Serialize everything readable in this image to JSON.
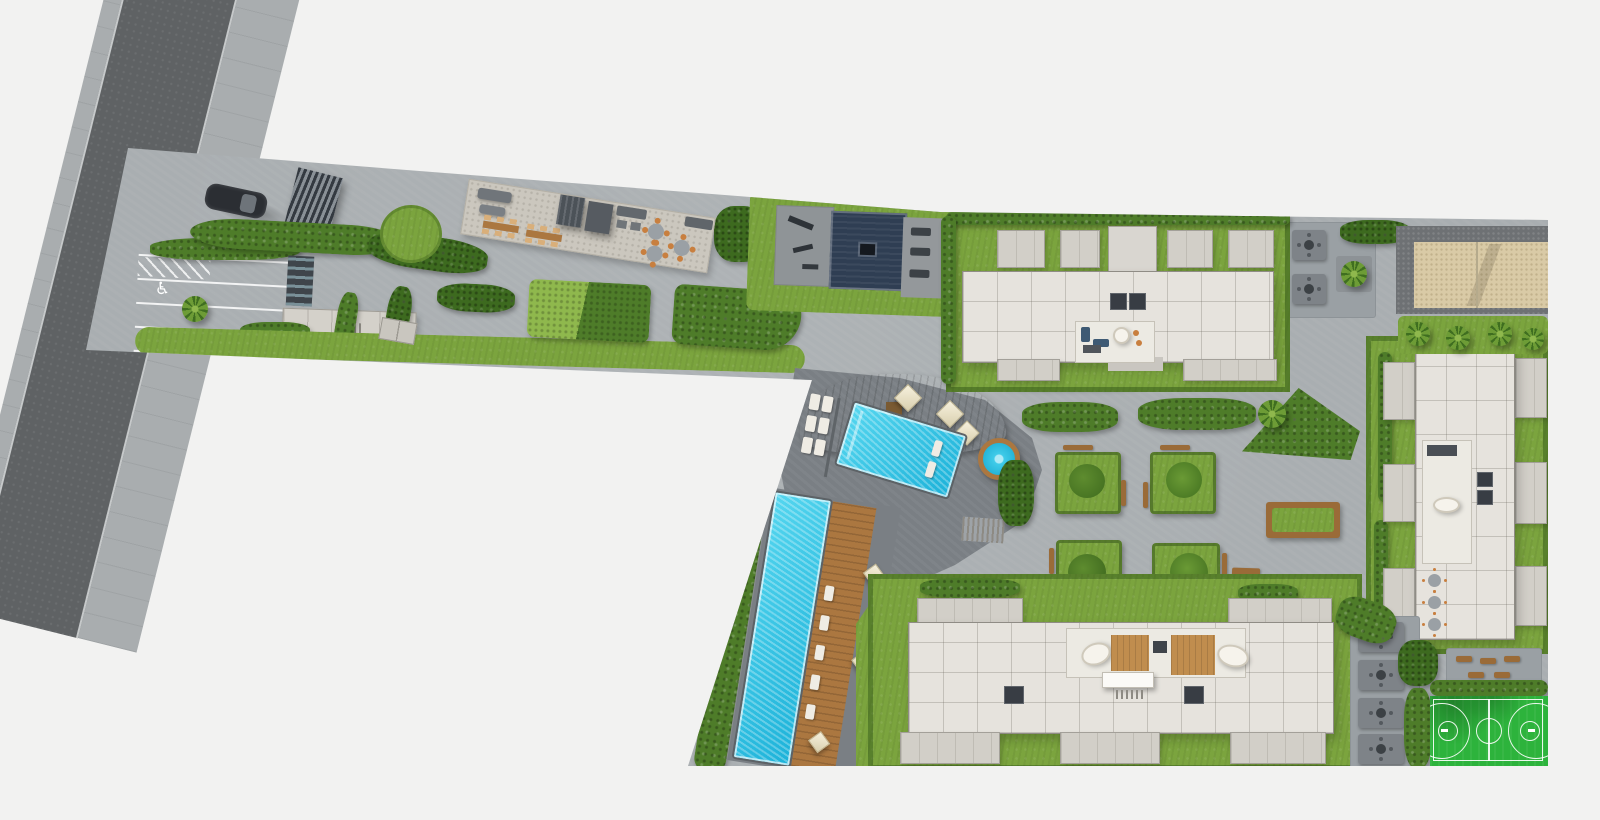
{
  "scene": {
    "title": "Aerial site plan rendering of a residential complex",
    "view": "top-down 3D render",
    "text_content": "none (pictorial rendering only)"
  },
  "colors": {
    "bg": "#f2f2f1",
    "road_asphalt": "#5f6264",
    "road_sidewalk": "#a9adaf",
    "curb": "#c6c9ca",
    "ground": "#a9aeb1",
    "deck_dark": "#7a7f84",
    "terrace_beige": "#cbc7be",
    "grass": "#7ba43e",
    "grass_light": "#8fb84d",
    "hedge": "#4e7c29",
    "hedge_dark": "#3d6a1f",
    "water": "#3fcbe9",
    "water_deep": "#17a8cf",
    "wood": "#ab7740",
    "wood_light": "#c08d4e",
    "roof": "#e6e3dd",
    "roof_dark": "#d2cfc8",
    "wall": "#8f8c85",
    "core": "#383d44",
    "lobby": "#eceae3",
    "court_green": "#2db33c",
    "line_white": "#ffffff",
    "sand": "#d9caa6",
    "gravel": "#6e7174",
    "mat_navy": "#2f3e53",
    "umbrella": "#efe7d0",
    "bench": "#9a6b38",
    "chair_orange": "#c87f3f",
    "car": "#2b2e33",
    "daybed": "#f6f3ec"
  },
  "features": {
    "road": {
      "label": "Access road"
    },
    "sidewalk": {
      "label": "Sidewalk"
    },
    "site": {
      "label": "Development site paving"
    },
    "parking": {
      "label": "Visitor parking",
      "spaces_visible": 5,
      "accessible_spaces": 1,
      "accessible_symbol": "♿"
    },
    "entry_car": {
      "label": "Car at site entrance"
    },
    "entry_gate": {
      "label": "Louvered entry gate"
    },
    "garage_ramp": {
      "label": "Ramp to underground garage"
    },
    "entrance_lobby": {
      "label": "Entrance lobby building with steps"
    },
    "amenity_terrace": {
      "label": "Amenity terrace with outdoor furniture",
      "dining_tables": 2,
      "pergolas": 2,
      "round_tables": 3
    },
    "fitness_area": {
      "label": "Outdoor fitness zone",
      "mat_label": "Navy exercise mat"
    },
    "main_pool": {
      "label": "Swimming pool"
    },
    "jacuzzi": {
      "label": "Round jacuzzi with timber ring"
    },
    "pool_wood_deck": {
      "label": "Curved timber pool deck"
    },
    "cabanas": {
      "label": "Pool cabanas / umbrellas",
      "count": 3
    },
    "pool_loungers": {
      "label": "Sun loungers"
    },
    "lap_pool": {
      "label": "Lap pool"
    },
    "lap_deck": {
      "label": "Timber lap-pool deck",
      "umbrellas": 3,
      "loungers": 5
    },
    "steps": {
      "label": "Steps to courtyard"
    },
    "building_a": {
      "label": "Residential building — north"
    },
    "building_b": {
      "label": "Residential building — east"
    },
    "building_c": {
      "label": "Residential building — south"
    },
    "elevator_core": {
      "label": "Elevator core"
    },
    "lobby": {
      "label": "Lobby with furniture"
    },
    "courtyard": {
      "label": "Central courtyard",
      "planters": 4
    },
    "planter": {
      "label": "Courtyard planter with tree and benches"
    },
    "planter_bench": {
      "label": "Rectangular planter bench"
    },
    "bbq_terrace": {
      "label": "Grill and dining terrace"
    },
    "sand_court": {
      "label": "Beach volleyball court with net"
    },
    "palm_row": {
      "label": "Palm trees"
    },
    "basketball_court": {
      "label": "Basketball court"
    },
    "picnic_area": {
      "label": "Picnic tables"
    },
    "seating_strip": {
      "label": "Outdoor seating area"
    },
    "hedges": {
      "label": "Hedges and shrubs"
    },
    "lawn": {
      "label": "Lawn"
    }
  }
}
